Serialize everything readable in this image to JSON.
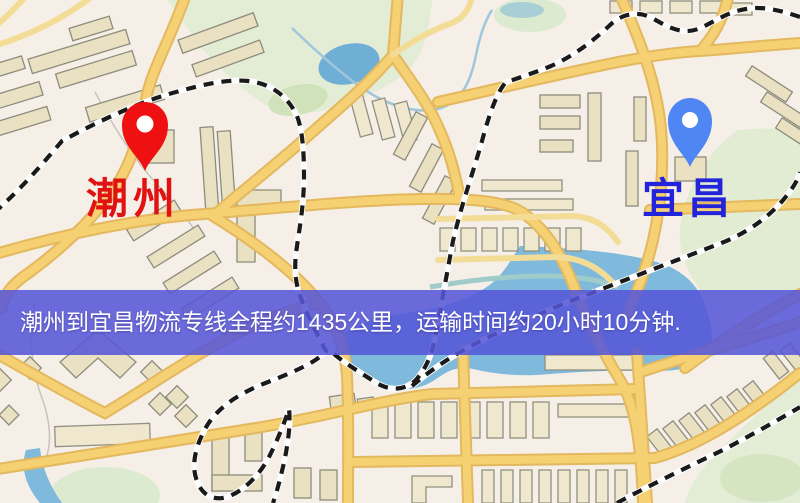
{
  "banner": {
    "text": "潮州到宜昌物流专线全程约1435公里，运输时间约20小时10分钟.",
    "background_color": "#5656d8",
    "text_color": "#ffffff"
  },
  "markers": {
    "origin": {
      "label": "潮州",
      "pin_icon": "red-pin-icon",
      "pin_color": "#ef1111",
      "label_color": "#e01212"
    },
    "destination": {
      "label": "宜昌",
      "pin_icon": "blue-pin-icon",
      "pin_color": "#4f86f3",
      "label_color": "#2323dc"
    }
  },
  "map_colors": {
    "background": "#f5efe8",
    "road_fill": "#f6d173",
    "road_casing": "#e3b85e",
    "minor_road": "#f3dd96",
    "water": "#7fb9dc",
    "park_green": "#e3ecd5",
    "railway_dash": "#1a1a1a"
  }
}
